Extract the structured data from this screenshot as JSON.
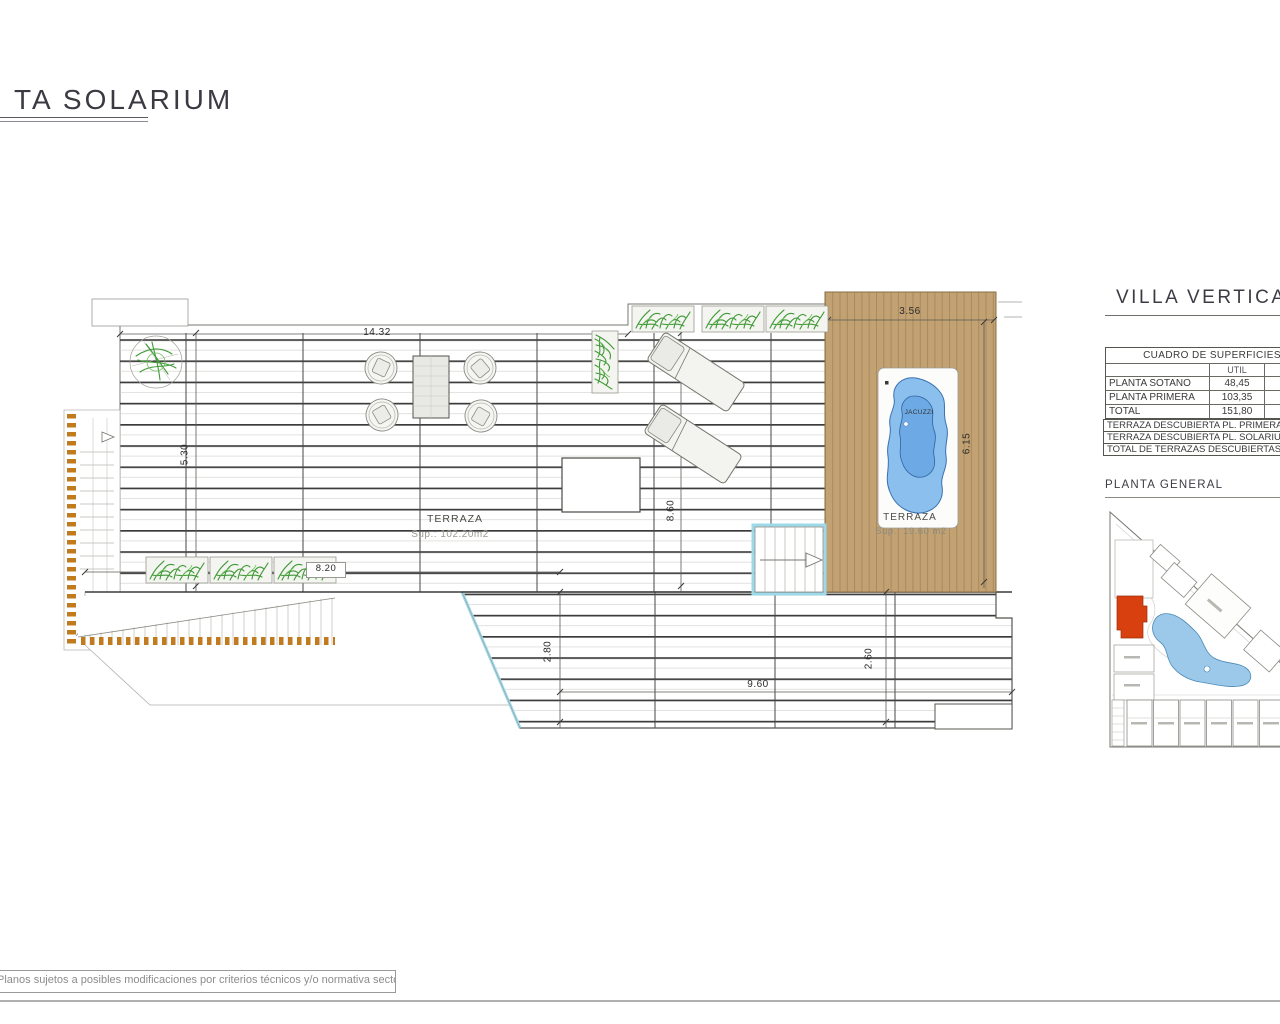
{
  "page": {
    "title": "TA SOLARIUM",
    "footer_note": "Planos sujetos a posibles modificaciones por criterios técnicos y/o normativa sectorial."
  },
  "plan": {
    "main_terrace": {
      "label": "TERRAZA",
      "area": "Sup.: 102.20m2"
    },
    "deck_terrace": {
      "label": "TERRAZA",
      "area": "Sup.: 19.60 m2"
    },
    "jacuzzi": {
      "label": "JACUZZI"
    },
    "dims": {
      "top_width": "14.32",
      "deck_width": "3.56",
      "left_height": "5.30",
      "mid_height": "8.60",
      "deck_height": "6.15",
      "planter_width": "8.20",
      "lower_left_height": "2.80",
      "lower_right_height": "2.60",
      "lower_width": "9.60"
    }
  },
  "sidebar": {
    "villa_title": "VILLA VERTICA",
    "surfaces_table": {
      "title": "CUADRO DE SUPERFICIES",
      "col_header": "UTIL",
      "rows": [
        {
          "label": "PLANTA SOTANO",
          "value": "48,45"
        },
        {
          "label": "PLANTA PRIMERA",
          "value": "103,35"
        },
        {
          "label": "TOTAL",
          "value": "151,80"
        }
      ]
    },
    "terrace_rows": [
      {
        "label": "TERRAZA DESCUBIERTA PL. PRIMERA"
      },
      {
        "label": "TERRAZA DESCUBIERTA PL. SOLARIU"
      },
      {
        "label": "TOTAL DE TERRAZAS DESCUBIERTAS"
      }
    ],
    "site_plan_title": "PLANTA GENERAL"
  },
  "colors": {
    "deck_wood": "#c2a172",
    "jacuzzi_blue": "#76b2e8",
    "glass_balustrade": "#9ed9e9",
    "plants_green": "#3f9a36",
    "stair_accent_orange": "#c27a1e",
    "site_highlight_red": "#d8400f",
    "site_pool_blue": "#9cc9ea"
  }
}
